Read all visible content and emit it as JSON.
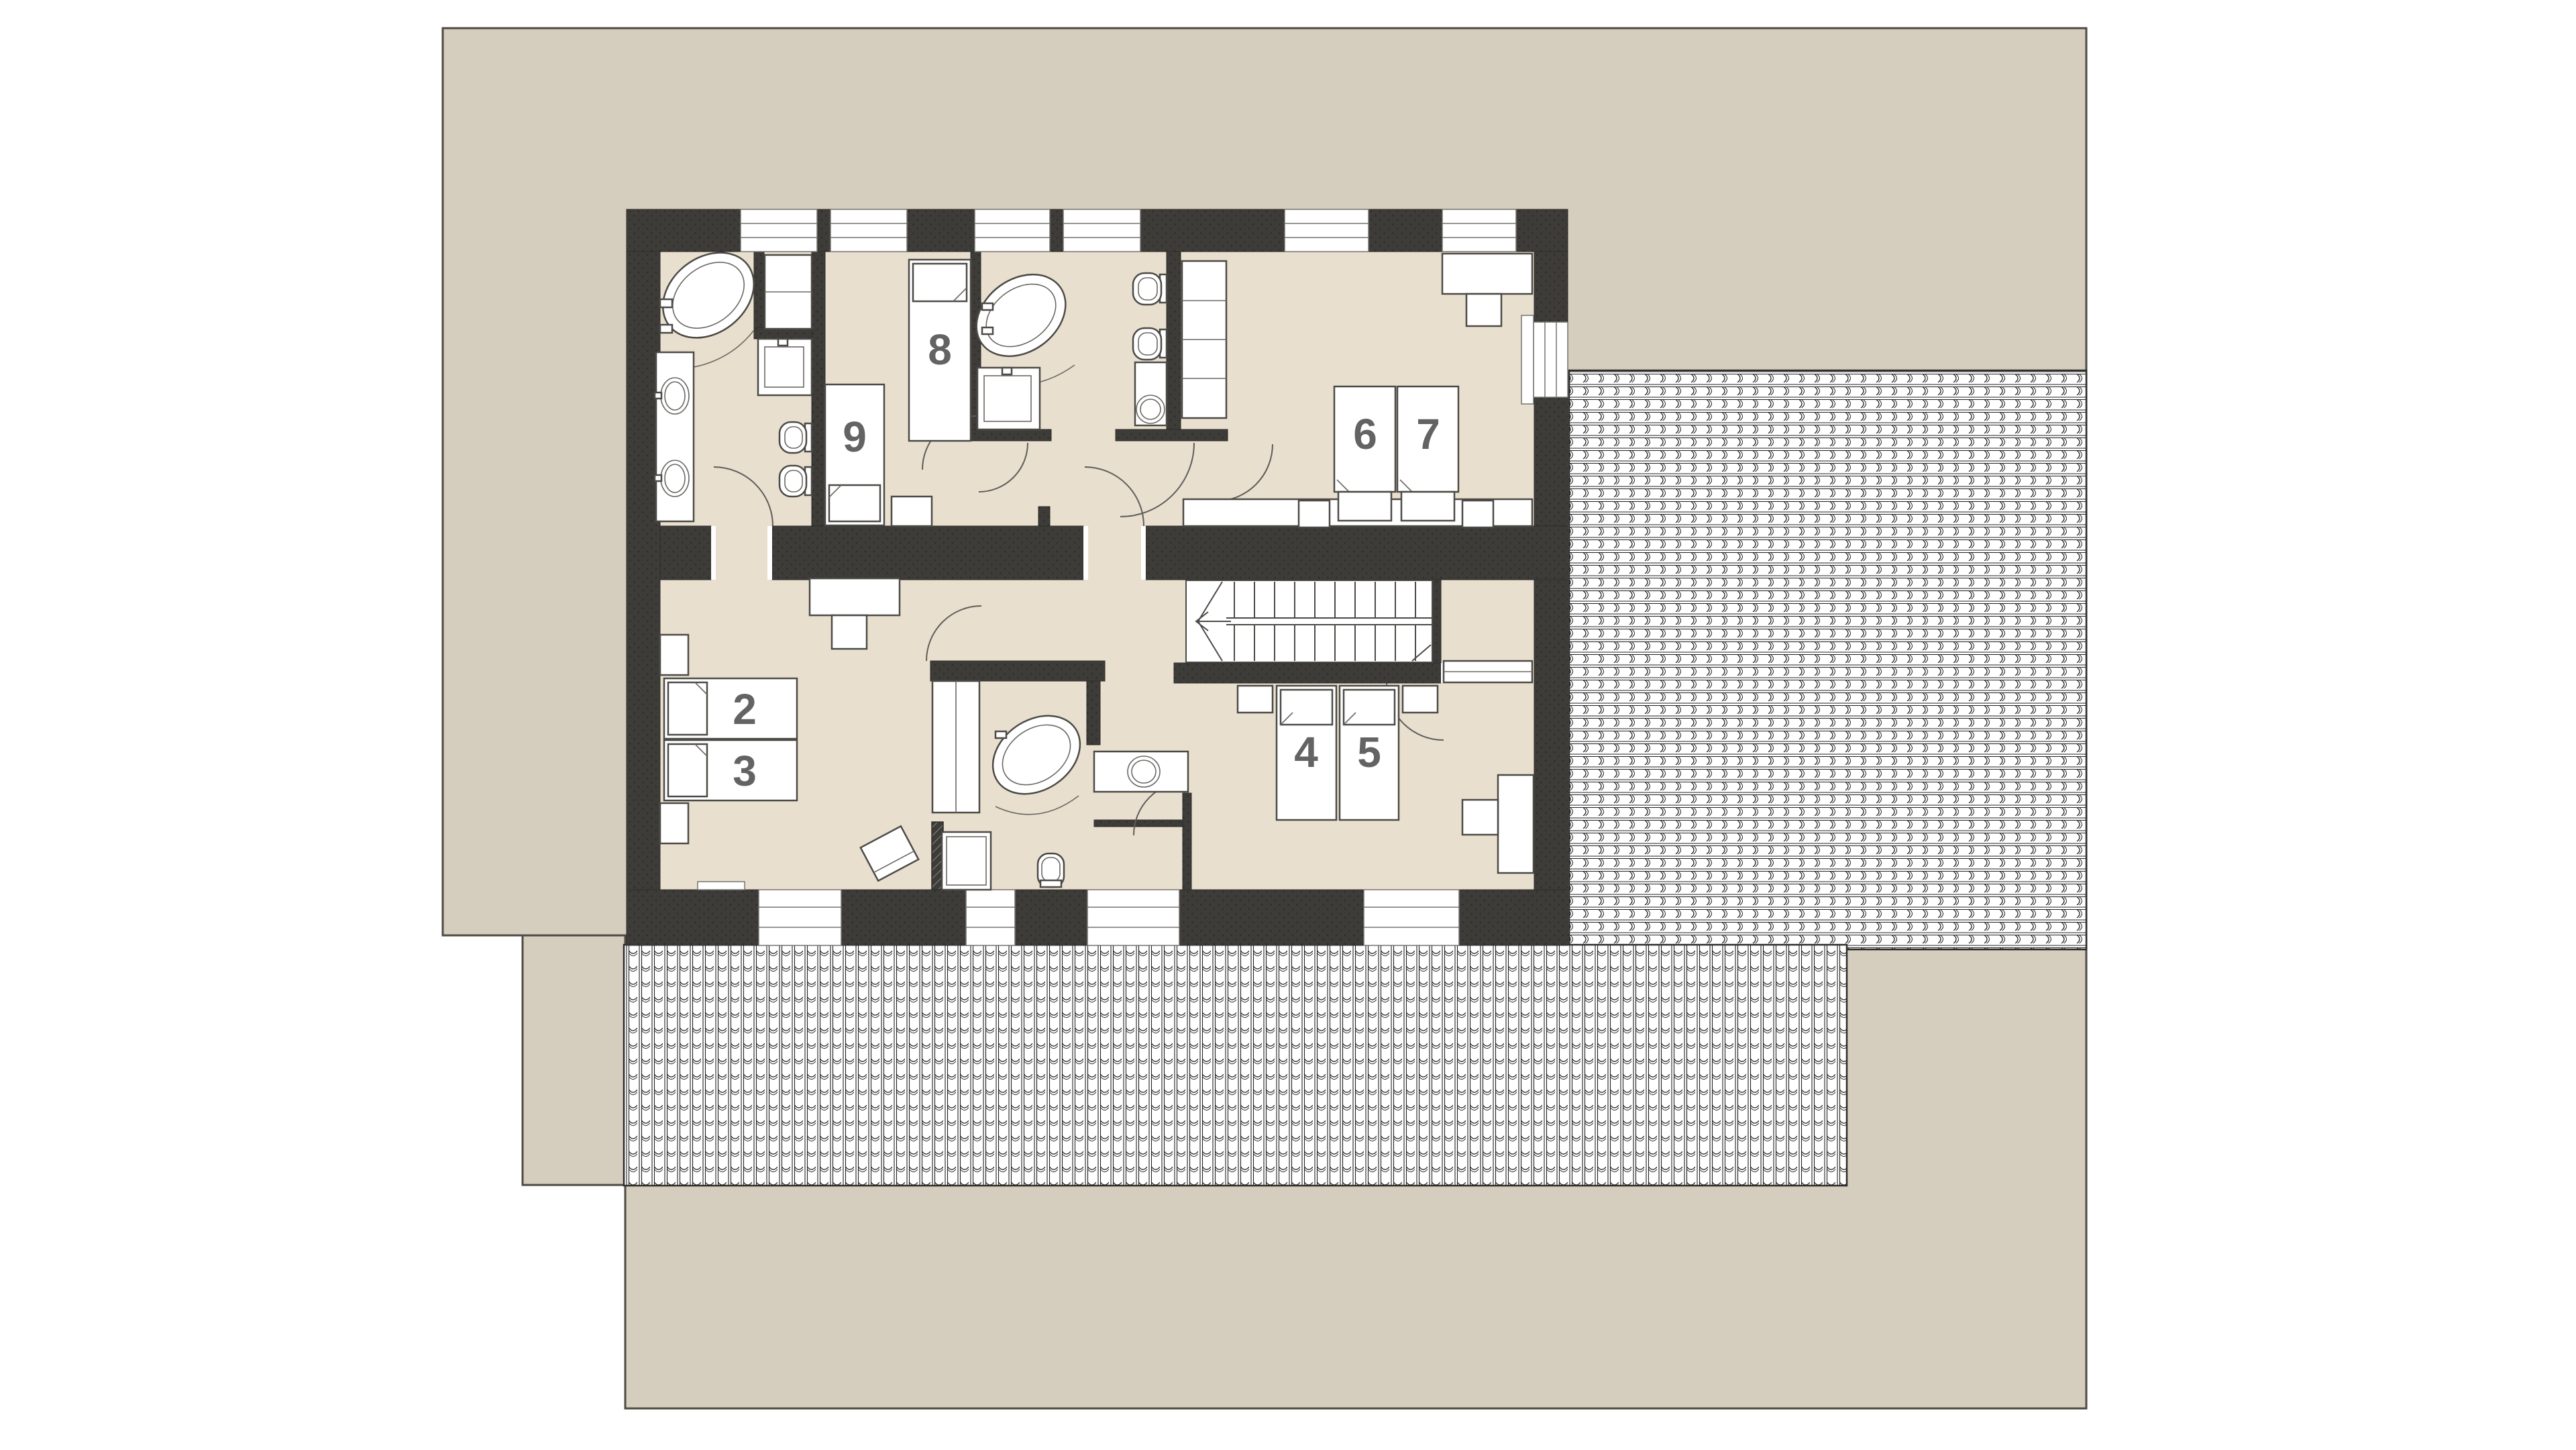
{
  "plan": {
    "colors": {
      "site": "#d5cdbd",
      "floor": "#e8dfcf",
      "wall": "#3e3c39",
      "wall_dot": "#2b2a27",
      "roof_bg": "#ffffff",
      "roof_line": "#1f1f1f",
      "outline": "#4d4a43",
      "furniture_stroke": "#4c4a46",
      "number": "#636363"
    },
    "beds": [
      {
        "id": "bed-2",
        "number": "2"
      },
      {
        "id": "bed-3",
        "number": "3"
      },
      {
        "id": "bed-4",
        "number": "4"
      },
      {
        "id": "bed-5",
        "number": "5"
      },
      {
        "id": "bed-6",
        "number": "6"
      },
      {
        "id": "bed-7",
        "number": "7"
      },
      {
        "id": "bed-8",
        "number": "8"
      },
      {
        "id": "bed-9",
        "number": "9"
      }
    ]
  }
}
